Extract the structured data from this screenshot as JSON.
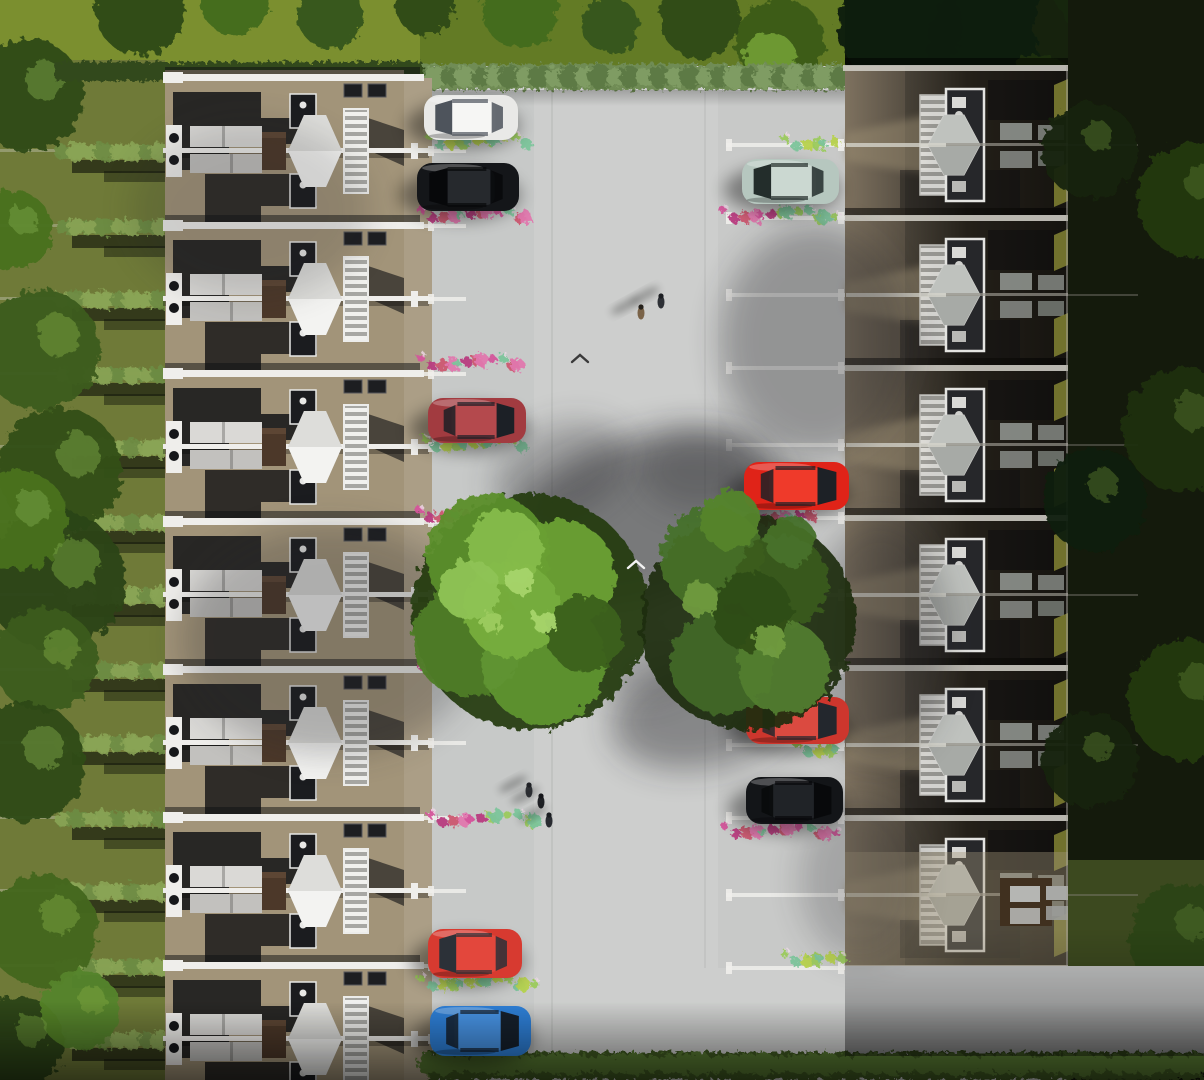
{
  "scene": {
    "description": "aerial-render-of-terraced-housing-development-with-central-parking-street",
    "canvas": {
      "w": 1204,
      "h": 1080
    },
    "palette": {
      "road": "#cdcecd",
      "road_bay": "#c3c4c4",
      "brick_left": "#a29479",
      "brick_path": "#ab9e86",
      "brick_right_lit": "#9a8c71",
      "white": "#efeeeb",
      "shadow": "#0e0f12",
      "grass_top": "#7b8f2f",
      "grass_top_dark": "#5f7823",
      "garden_left": "#6f7a38",
      "hedge_light": "#8aa455",
      "hedge_mid": "#6d8c43",
      "hedge_dark": "#3f5a22",
      "tree_bright": "#76ad3c",
      "tree_mid": "#578a29",
      "tree_deep": "#2d4c13",
      "tree_black": "#16270c",
      "flower_pink": "#d4549b",
      "flower_magenta": "#b83b80",
      "flower_crimson": "#cc5770",
      "flower_rose": "#e077ae",
      "shrub_teal": "#7cc49b",
      "shrub_green": "#9bca5c",
      "shrub_yellow": "#b7d24e",
      "olive_panel": "#7c7c31",
      "garage_brown": "#40301f"
    },
    "layout": {
      "left_garden": {
        "x": 0,
        "w": 165
      },
      "left_houses": {
        "x": 165,
        "w": 239,
        "first_ridge": 78,
        "unit_h": 148,
        "fence_offset": 73,
        "count": 8
      },
      "left_path": {
        "x": 404,
        "w": 28
      },
      "road": {
        "x": 404,
        "w": 800,
        "top": 92
      },
      "right_houses": {
        "x": 845,
        "w": 223,
        "first_ridge": 68,
        "unit_h": 150,
        "fence_offset": 77,
        "count": 6,
        "bottom_ridge": 968
      },
      "right_garden": {
        "x": 1068,
        "w": 136
      },
      "top_hedge": {
        "x": 420,
        "y": 64,
        "w": 425,
        "h": 26
      },
      "bottom_hedge": {
        "x": 428,
        "y": 1052,
        "w": 776,
        "h": 28
      }
    },
    "cars": [
      {
        "name": "white-hatchback",
        "x": 424,
        "y": 95,
        "w": 94,
        "h": 45,
        "body": "#e9e9e7",
        "roof": "#f6f6f4",
        "glass": "#4e545c",
        "facing": "left"
      },
      {
        "name": "black-hatchback",
        "x": 417,
        "y": 163,
        "w": 102,
        "h": 48,
        "body": "#141619",
        "roof": "#26292d",
        "glass": "#07080a",
        "facing": "left"
      },
      {
        "name": "maroon-sedan",
        "x": 428,
        "y": 398,
        "w": 98,
        "h": 45,
        "body": "#a23b40",
        "roof": "#b4494d",
        "glass": "#1c2026",
        "facing": "right"
      },
      {
        "name": "red-hatchback-left",
        "x": 428,
        "y": 929,
        "w": 94,
        "h": 49,
        "body": "#d73a30",
        "roof": "#e3473c",
        "glass": "#2c3138",
        "facing": "left"
      },
      {
        "name": "blue-hatchback",
        "x": 430,
        "y": 1006,
        "w": 101,
        "h": 50,
        "body": "#2e7fd6",
        "roof": "#4793e4",
        "glass": "#16202c",
        "facing": "right"
      },
      {
        "name": "silver-green-hatchback",
        "x": 742,
        "y": 159,
        "w": 97,
        "h": 45,
        "body": "#b6c7bf",
        "roof": "#cbd8d1",
        "glass": "#232d2b",
        "facing": "left"
      },
      {
        "name": "red-hatchback-right",
        "x": 744,
        "y": 462,
        "w": 105,
        "h": 48,
        "body": "#e02318",
        "roof": "#ef3a2a",
        "glass": "#1d2126",
        "facing": "right"
      },
      {
        "name": "red-suv",
        "x": 746,
        "y": 697,
        "w": 103,
        "h": 47,
        "body": "#cd362d",
        "roof": "#db4a40",
        "glass": "#23272d",
        "facing": "right"
      },
      {
        "name": "black-suv",
        "x": 746,
        "y": 777,
        "w": 97,
        "h": 47,
        "body": "#131518",
        "roof": "#202327",
        "glass": "#08090b",
        "facing": "right"
      }
    ],
    "street_trees": [
      {
        "name": "street-tree-left",
        "cx": 530,
        "cy": 612,
        "base_r": 118,
        "base_c": "#223a10",
        "blobs": [
          [
            488,
            556,
            62,
            "#5c8f2b"
          ],
          [
            560,
            576,
            56,
            "#6aa033"
          ],
          [
            468,
            640,
            56,
            "#4f7d26"
          ],
          [
            544,
            662,
            62,
            "#5f9431"
          ],
          [
            512,
            610,
            48,
            "#76ad3c"
          ],
          [
            585,
            634,
            38,
            "#3b611d"
          ],
          [
            505,
            548,
            38,
            "#85bb4a"
          ],
          [
            470,
            590,
            30,
            "#8fc354"
          ],
          [
            520,
            580,
            14,
            "#a5d36a"
          ],
          [
            545,
            622,
            12,
            "#a5d36a"
          ],
          [
            492,
            622,
            11,
            "#9ccb5f"
          ]
        ]
      },
      {
        "name": "street-tree-right",
        "cx": 748,
        "cy": 622,
        "base_r": 108,
        "base_c": "#1c2d0d",
        "blobs": [
          [
            712,
            558,
            52,
            "#47702a"
          ],
          [
            782,
            582,
            47,
            "#3a5c1e"
          ],
          [
            722,
            662,
            52,
            "#41682a"
          ],
          [
            784,
            668,
            46,
            "#527c30"
          ],
          [
            752,
            612,
            40,
            "#2f4d17"
          ],
          [
            730,
            520,
            30,
            "#55842d"
          ],
          [
            790,
            540,
            25,
            "#47702a"
          ],
          [
            700,
            600,
            18,
            "#6f9a3f"
          ],
          [
            770,
            640,
            16,
            "#6f9a3f"
          ]
        ]
      }
    ],
    "top_trees": [
      [
        140,
        10,
        45,
        "#2d4a15"
      ],
      [
        235,
        0,
        35,
        "#436b1e"
      ],
      [
        330,
        15,
        33,
        "#35571a"
      ],
      [
        425,
        5,
        30,
        "#2d4a15"
      ],
      [
        520,
        10,
        38,
        "#436b1e"
      ],
      [
        610,
        25,
        28,
        "#35571a"
      ],
      [
        700,
        18,
        40,
        "#2d4a15"
      ],
      [
        780,
        42,
        44,
        "#3c5c19"
      ],
      [
        770,
        58,
        26,
        "#6e9a34"
      ],
      [
        900,
        25,
        62,
        "#0f1c08"
      ],
      [
        1000,
        48,
        72,
        "#101d08"
      ],
      [
        1100,
        30,
        66,
        "#15250c"
      ],
      [
        1180,
        62,
        70,
        "#0f1c08"
      ],
      [
        1040,
        95,
        40,
        "#1c300e"
      ]
    ],
    "left_edge_trees": [
      [
        28,
        95,
        56,
        "#2f4a17"
      ],
      [
        12,
        230,
        40,
        "#49701f"
      ],
      [
        40,
        350,
        60,
        "#3c5c1d"
      ],
      [
        60,
        470,
        62,
        "#344f18"
      ],
      [
        55,
        580,
        70,
        "#2b4414"
      ],
      [
        18,
        520,
        50,
        "#49701f"
      ],
      [
        45,
        660,
        52,
        "#3c5c1d"
      ],
      [
        25,
        762,
        60,
        "#2f4a17"
      ],
      [
        42,
        930,
        56,
        "#44661e"
      ],
      [
        18,
        1042,
        46,
        "#2b4414"
      ],
      [
        80,
        1010,
        40,
        "#55832a"
      ]
    ],
    "right_garden_trees": [
      [
        1195,
        200,
        58,
        "#243a10"
      ],
      [
        1185,
        430,
        62,
        "#1e300d"
      ],
      [
        1190,
        700,
        62,
        "#243a10"
      ],
      [
        1185,
        940,
        56,
        "#2b4414"
      ],
      [
        1090,
        150,
        48,
        "#16250a"
      ],
      [
        1095,
        500,
        52,
        "#121f08"
      ],
      [
        1090,
        760,
        48,
        "#16250a"
      ],
      [
        1120,
        1040,
        50,
        "#31491a"
      ]
    ],
    "veg_rows": {
      "left": [
        {
          "x": 432,
          "y": 140,
          "w": 100,
          "k": "shrub"
        },
        {
          "x": 424,
          "y": 214,
          "w": 112,
          "k": "flower"
        },
        {
          "x": 424,
          "y": 362,
          "w": 104,
          "k": "flower"
        },
        {
          "x": 428,
          "y": 443,
          "w": 100,
          "k": "shrub"
        },
        {
          "x": 422,
          "y": 514,
          "w": 52,
          "k": "flower"
        },
        {
          "x": 424,
          "y": 670,
          "w": 54,
          "k": "flower"
        },
        {
          "x": 434,
          "y": 818,
          "w": 112,
          "k": "mix"
        },
        {
          "x": 424,
          "y": 982,
          "w": 120,
          "k": "shrub"
        }
      ],
      "right": [
        {
          "x": 788,
          "y": 142,
          "w": 56,
          "k": "shrub"
        },
        {
          "x": 726,
          "y": 214,
          "w": 118,
          "k": "mix"
        },
        {
          "x": 756,
          "y": 516,
          "w": 62,
          "k": "flower"
        },
        {
          "x": 750,
          "y": 662,
          "w": 82,
          "k": "flower"
        },
        {
          "x": 800,
          "y": 748,
          "w": 46,
          "k": "shrub"
        },
        {
          "x": 728,
          "y": 830,
          "w": 117,
          "k": "flower"
        },
        {
          "x": 788,
          "y": 958,
          "w": 60,
          "k": "shrub"
        }
      ]
    },
    "soft_shadows": [
      {
        "x": 642,
        "y": 520,
        "rx": 150,
        "ry": 82,
        "rot": -18,
        "o": 0.5
      },
      {
        "x": 705,
        "y": 712,
        "rx": 95,
        "ry": 55,
        "rot": -12,
        "o": 0.42
      },
      {
        "x": 330,
        "y": 640,
        "rx": 150,
        "ry": 115,
        "rot": 0,
        "o": 0.25
      },
      {
        "x": 250,
        "y": 210,
        "rx": 120,
        "ry": 90,
        "rot": 0,
        "o": 0.16
      },
      {
        "x": 815,
        "y": 340,
        "rx": 95,
        "ry": 115,
        "rot": 0,
        "o": 0.32
      },
      {
        "x": 700,
        "y": 470,
        "rx": 60,
        "ry": 40,
        "rot": 0,
        "o": 0.25
      },
      {
        "x": 560,
        "y": 470,
        "rx": 70,
        "ry": 45,
        "rot": -20,
        "o": 0.28
      },
      {
        "x": 640,
        "y": 660,
        "rx": 60,
        "ry": 40,
        "rot": 0,
        "o": 0.22
      },
      {
        "x": 880,
        "y": 640,
        "rx": 70,
        "ry": 120,
        "rot": 0,
        "o": 0.28
      },
      {
        "x": 860,
        "y": 880,
        "rx": 60,
        "ry": 80,
        "rot": 0,
        "o": 0.22
      }
    ],
    "people": [
      {
        "x": 641,
        "y": 313,
        "body": "#7a6348",
        "head": "#26221c"
      },
      {
        "x": 661,
        "y": 302,
        "body": "#2e3136",
        "head": "#1c1e22"
      },
      {
        "x": 529,
        "y": 791,
        "body": "#35383d",
        "head": "#222428"
      },
      {
        "x": 541,
        "y": 802,
        "body": "#202226",
        "head": "#15161a"
      },
      {
        "x": 549,
        "y": 821,
        "body": "#282b30",
        "head": "#1a1c20"
      }
    ],
    "birds": [
      {
        "x": 636,
        "y": 564,
        "c": "#f2f2f2"
      },
      {
        "x": 580,
        "y": 358,
        "c": "#3a3a3a"
      }
    ]
  }
}
